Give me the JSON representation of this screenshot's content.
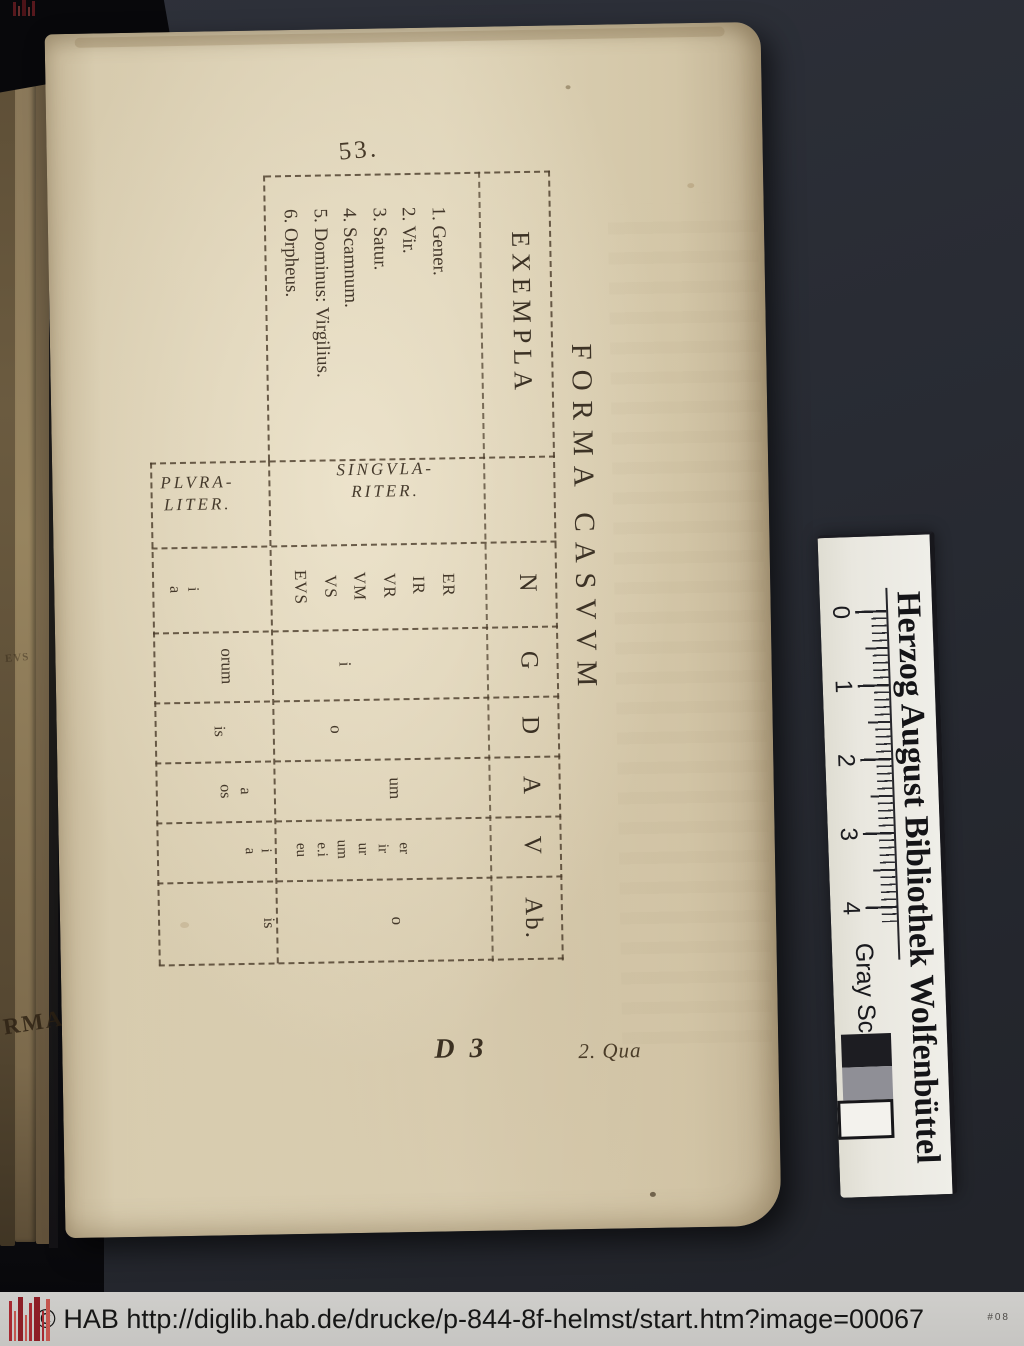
{
  "colors": {
    "background": "#282b33",
    "paper": "#dbcfb4",
    "ink": "#3a3025",
    "footer_bar": "#c8c7c5",
    "card_white": "#edece6",
    "stamp_red": "#a62830",
    "gray_square": "#8f8f96"
  },
  "page": {
    "folio": "53.",
    "signature": "D 3",
    "catchword": "2. Qua",
    "edge_fragments": [
      "EVS",
      "RMA"
    ],
    "table": {
      "title": "FORMA CASVVM",
      "columns": [
        "EXEMPLA",
        "N",
        "G",
        "D",
        "A",
        "V",
        "Ab."
      ],
      "examples": [
        "1. Gener.",
        "2. Vir.",
        "3. Satur.",
        "4. Scamnum.",
        "5. Dominus: Virgilius.",
        "6. Orpheus."
      ],
      "singular_label": [
        "SINGVLA-",
        "RITER."
      ],
      "plural_label": [
        "PLVRA-",
        "LITER."
      ],
      "singular": {
        "N": [
          "ER",
          "IR",
          "VR",
          "VM",
          "VS",
          "EVS"
        ],
        "G": "i",
        "D": "o",
        "A": "um",
        "V": [
          "er",
          "ir",
          "ur",
          "um",
          "e.i",
          "eu"
        ],
        "Ab": "o"
      },
      "plural": {
        "N": [
          "i",
          "a"
        ],
        "G": "orum",
        "D": "is",
        "A": [
          "a",
          "os"
        ],
        "V": [
          "i",
          "a"
        ],
        "Ab": "is"
      }
    }
  },
  "ruler": {
    "institution": "Herzog August Bibliothek Wolfenbüttel",
    "scale_label": "Gray Scale",
    "ticks": [
      "0",
      "1",
      "2",
      "3",
      "4"
    ]
  },
  "footer": {
    "text": "© HAB http://diglib.hab.de/drucke/p-844-8f-helmst/start.htm?image=00067",
    "marker": "#08"
  }
}
